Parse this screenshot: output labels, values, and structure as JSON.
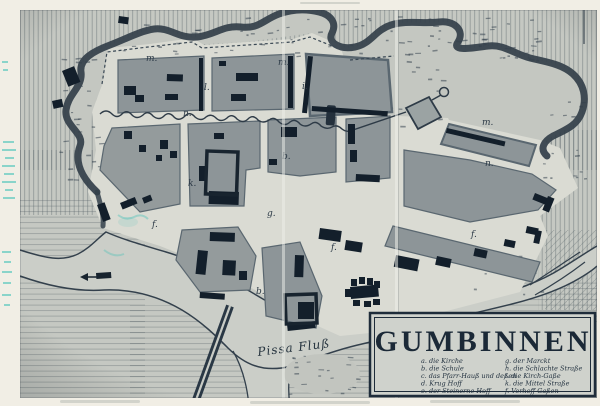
{
  "cartouche": {
    "title": "GUMBINNEN",
    "legend_left": [
      "a. die Kirche",
      "b. die Schule",
      "c. das Pfarr-Hauß und deßen",
      "d. Krug Hoff",
      "e. der Steinerne Hoff"
    ],
    "legend_right": [
      "g. der Marckt",
      "h. die Schlachte Straße",
      "i. die Kirch-Gaße",
      "k. die Mittel Straße",
      "f. Vorhoff Gaßen"
    ]
  },
  "river_label": "Pissa Fluß",
  "map_letters": [
    {
      "text": "m."
    },
    {
      "text": "m."
    },
    {
      "text": "m."
    },
    {
      "text": "n."
    },
    {
      "text": "n."
    },
    {
      "text": "l."
    },
    {
      "text": "i."
    },
    {
      "text": "k."
    },
    {
      "text": "g."
    },
    {
      "text": "f."
    },
    {
      "text": "f."
    },
    {
      "text": "f."
    },
    {
      "text": "b."
    },
    {
      "text": "b."
    }
  ],
  "colors": {
    "paper": "#f1eee5",
    "photo_bg": "#c5c8c2",
    "street": "#dadbd3",
    "block": "#8d9598",
    "building": "#131f2b",
    "ink": "#2a3845",
    "moat_band": "#333f4a",
    "legend_bg": "#cfd2cc",
    "cyan_mark": "#2fbdb4"
  }
}
